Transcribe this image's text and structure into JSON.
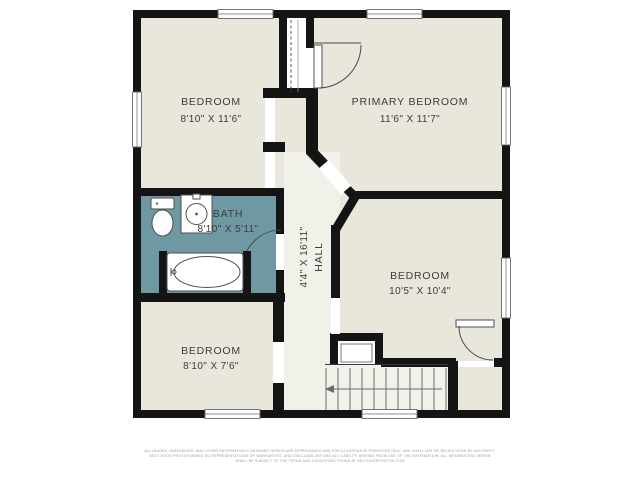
{
  "colors": {
    "wall": "#141414",
    "floor": "#e9e6dc",
    "hall": "#f1f0e9",
    "bath": "#6e99a2",
    "label": "#3c3c3c",
    "muted": "#9a9a9a",
    "bg": "#ffffff",
    "line": "#555555"
  },
  "rooms": {
    "bedroom_top_left": {
      "name": "BEDROOM",
      "dims": "8'10\" X 11'6\""
    },
    "primary_bedroom": {
      "name": "PRIMARY BEDROOM",
      "dims": "11'6\" X 11'7\""
    },
    "bath": {
      "name": "BATH",
      "dims": "8'10\" X 5'11\""
    },
    "hall": {
      "name": "HALL",
      "dims": "4'4\" X 16'11\""
    },
    "bedroom_right": {
      "name": "BEDROOM",
      "dims": "10'5\" X 10'4\""
    },
    "bedroom_bottom_left": {
      "name": "BEDROOM",
      "dims": "8'10\" X 7'6\""
    }
  },
  "disclaimer": {
    "line1": "ALL IMAGES, DIMENSIONS, AND OTHER INFORMATION CONTAINED HEREIN ARE APPROXIMATE AND FOR ILLUSTRATIVE PURPOSES ONLY, AND SHALL NOT BE RELIED UPON BY ANY PARTY.",
    "line2": "NEXT DOOR PHOTOS MAKES NO REPRESENTATIONS OR WARRANTIES, AND DISCLAIMS ANY AND ALL LIABILITY ARISING FROM USE OF THE INFORMATION. ALL INFORMATION HEREIN",
    "line3": "SHALL BE SUBJECT TO THE TERMS AND CONDITIONS FOUND AT NEXTDOORPHOTOS.COM"
  }
}
